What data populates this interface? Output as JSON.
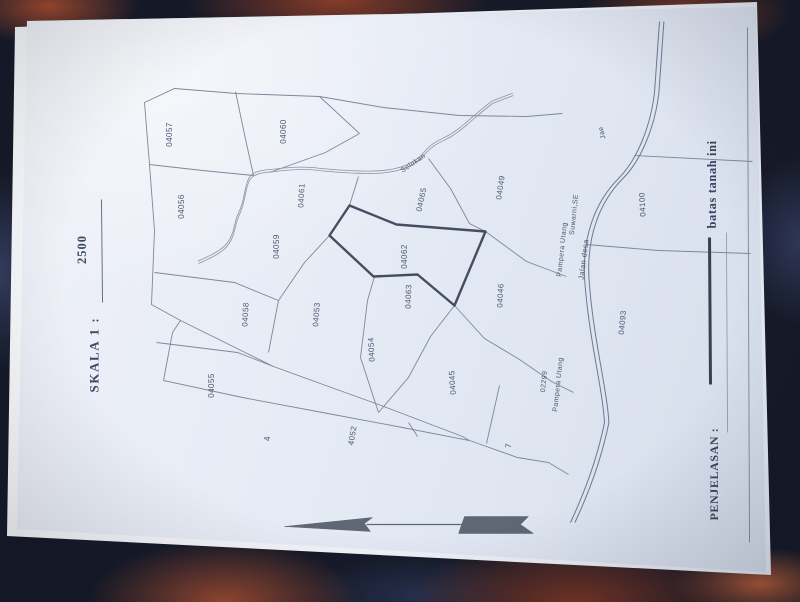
{
  "title": {
    "skala_label": "SKALA 1 :",
    "skala_value": "2500"
  },
  "legend": {
    "penjelasan_label": "PENJELASAN :",
    "boundary_label": "batas tanah ini"
  },
  "highlighted_parcel": "04062",
  "parcel_labels": [
    {
      "id": "04057",
      "label": "04057",
      "u": 428,
      "v": 147,
      "r": 0,
      "fs": 8
    },
    {
      "id": "04060",
      "label": "04060",
      "u": 431,
      "v": 261,
      "r": 0,
      "fs": 8
    },
    {
      "id": "04056",
      "label": "04056",
      "u": 356,
      "v": 159,
      "r": 0,
      "fs": 8
    },
    {
      "id": "04061",
      "label": "04061",
      "u": 367,
      "v": 279,
      "r": 3,
      "fs": 8
    },
    {
      "id": "04059",
      "label": "04059",
      "u": 316,
      "v": 254,
      "r": 0,
      "fs": 8
    },
    {
      "id": "04058",
      "label": "04058",
      "u": 248,
      "v": 223,
      "r": 3,
      "fs": 8
    },
    {
      "id": "04055",
      "label": "04055",
      "u": 177,
      "v": 189,
      "r": 0,
      "fs": 8
    },
    {
      "id": "04053",
      "label": "04053",
      "u": 248,
      "v": 294,
      "r": 4,
      "fs": 8
    },
    {
      "id": "04054",
      "label": "04054",
      "u": 213,
      "v": 349,
      "r": -3,
      "fs": 8
    },
    {
      "id": "04062",
      "label": "04062",
      "u": 306,
      "v": 382,
      "r": 0,
      "fs": 8
    },
    {
      "id": "04063",
      "label": "04063",
      "u": 266,
      "v": 386,
      "r": 2,
      "fs": 8
    },
    {
      "id": "04065",
      "label": "04065",
      "u": 363,
      "v": 399,
      "r": 12,
      "fs": 8
    },
    {
      "id": "04049",
      "label": "04049",
      "u": 375,
      "v": 478,
      "r": 8,
      "fs": 8
    },
    {
      "id": "04046",
      "label": "04046",
      "u": 267,
      "v": 478,
      "r": 3,
      "fs": 8
    },
    {
      "id": "04045",
      "label": "04045",
      "u": 180,
      "v": 430,
      "r": -4,
      "fs": 8
    },
    {
      "id": "4052",
      "label": "4052",
      "u": 127,
      "v": 330,
      "r": 10,
      "fs": 8
    },
    {
      "id": "4",
      "label": "4",
      "u": 124,
      "v": 245,
      "r": 0,
      "fs": 8
    },
    {
      "id": "7",
      "label": "7",
      "u": 117,
      "v": 486,
      "r": 5,
      "fs": 8
    },
    {
      "id": "04093",
      "label": "04093",
      "u": 240,
      "v": 600,
      "r": 5,
      "fs": 8
    },
    {
      "id": "04100",
      "label": "04100",
      "u": 358,
      "v": 620,
      "r": -3,
      "fs": 8
    }
  ],
  "feature_labels": [
    {
      "id": "selokan",
      "label": "Selokan",
      "u": 399,
      "v": 391,
      "r": 56,
      "fs": 7
    },
    {
      "id": "jalan-desa",
      "label": "Jalan desa",
      "u": 303,
      "v": 561,
      "r": 7,
      "fs": 7.5
    },
    {
      "id": "jae",
      "label": "Jae",
      "u": 430,
      "v": 580,
      "r": -15,
      "fs": 7
    },
    {
      "id": "owner-name",
      "label": "Pampera Utang",
      "u": 313,
      "v": 540,
      "r": 6,
      "fs": 7
    },
    {
      "id": "owner-title",
      "label": "Suwarni,SE",
      "u": 348,
      "v": 552,
      "r": 6,
      "fs": 7
    },
    {
      "id": "owner2-number",
      "label": "02299",
      "u": 181,
      "v": 522,
      "r": 6,
      "fs": 7
    },
    {
      "id": "owner2-name",
      "label": "Pampera Utang",
      "u": 178,
      "v": 536,
      "r": 6,
      "fs": 7
    }
  ],
  "colors": {
    "paper": "#e9edf5",
    "parcel_line": "#7d879b",
    "bold_outline": "#454e60",
    "label_text": "#4d576f",
    "heading_text": "#3d4865",
    "table_base": "#161a28"
  }
}
